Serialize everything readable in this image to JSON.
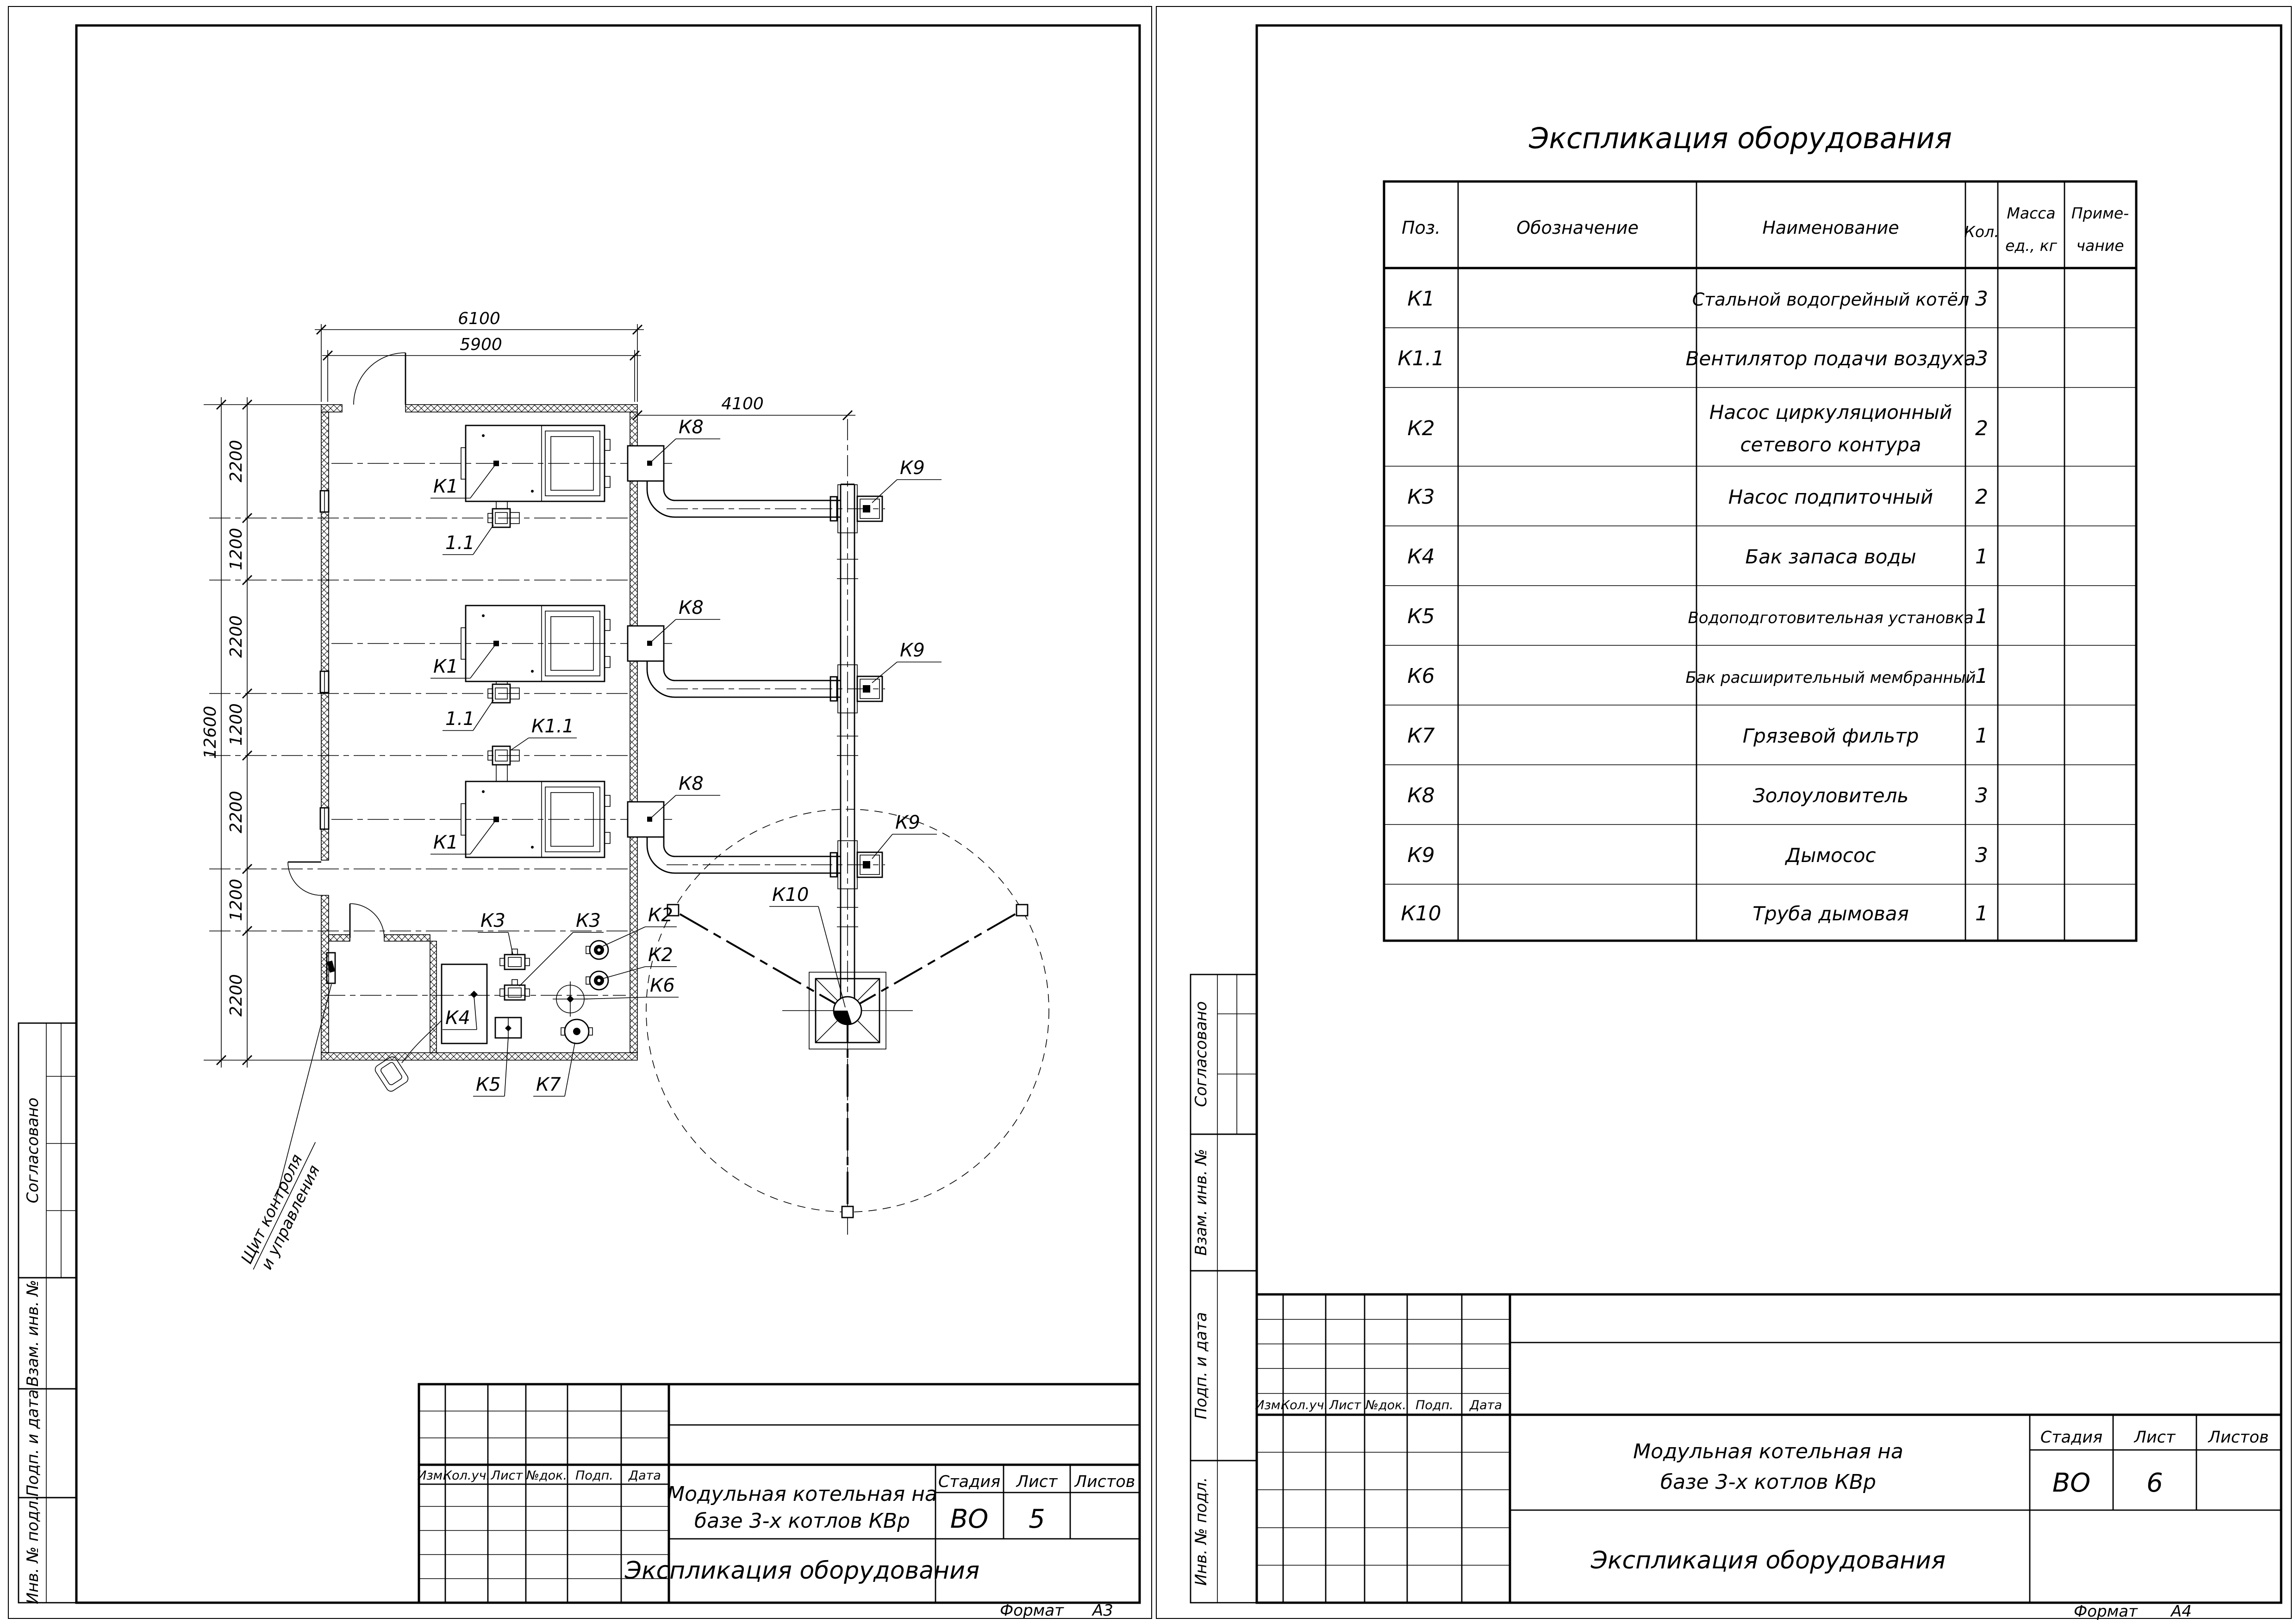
{
  "colors": {
    "paper": "#ffffff",
    "ink": "#000000"
  },
  "plan": {
    "dims": {
      "top_outer": "6100",
      "top_inner": "5900",
      "right": "4100",
      "total": "12600",
      "chain": [
        "2200",
        "1200",
        "2200",
        "1200",
        "2200",
        "1200",
        "2200"
      ]
    },
    "labels": {
      "boiler": "К1",
      "fan_a": "1.1",
      "fan_b": "К1.1",
      "ash": "К8",
      "smoke": "К9",
      "chimney": "К10",
      "pump_feed": "К3",
      "pump_net": "К2",
      "exp_tank": "К6",
      "tank": "К4",
      "wtp": "К5",
      "filter": "К7",
      "panel1": "Щит контроля",
      "panel2": "и управления"
    }
  },
  "equip_table": {
    "title": "Экспликация оборудования",
    "headers": {
      "pos": "Поз.",
      "code": "Обозначение",
      "name": "Наименование",
      "qty": "Кол.",
      "mass1": "Масса",
      "mass2": "ед., кг",
      "note1": "Приме-",
      "note2": "чание"
    },
    "rows": [
      {
        "pos": "К1",
        "name": "Стальной водогрейный котёл",
        "qty": "3"
      },
      {
        "pos": "К1.1",
        "name": "Вентилятор подачи воздуха",
        "qty": "3"
      },
      {
        "pos": "К2",
        "name": "Насос циркуляционный",
        "name2": "сетевого контура",
        "qty": "2"
      },
      {
        "pos": "К3",
        "name": "Насос подпиточный",
        "qty": "2"
      },
      {
        "pos": "К4",
        "name": "Бак запаса воды",
        "qty": "1"
      },
      {
        "pos": "К5",
        "name": "Водоподготовительная установка",
        "qty": "1"
      },
      {
        "pos": "К6",
        "name": "Бак расширительный мембранный",
        "qty": "1"
      },
      {
        "pos": "К7",
        "name": "Грязевой фильтр",
        "qty": "1"
      },
      {
        "pos": "К8",
        "name": "Золоуловитель",
        "qty": "3"
      },
      {
        "pos": "К9",
        "name": "Дымосос",
        "qty": "3"
      },
      {
        "pos": "К10",
        "name": "Труба дымовая",
        "qty": "1"
      }
    ]
  },
  "stamp": {
    "approved": "Согласовано",
    "zam": "Взам. инв. №",
    "podp": "Подп. и дата",
    "inv": "Инв. № подл."
  },
  "title_block": {
    "rev": [
      "Изм.",
      "Кол.уч.",
      "Лист",
      "№док.",
      "Подп.",
      "Дата"
    ],
    "project1": "Модульная котельная на",
    "project2": "базе 3-х котлов КВр",
    "doc": "Экспликация оборудования",
    "stage_h": "Стадия",
    "sheet_h": "Лист",
    "sheets_h": "Листов",
    "stage": "ВО",
    "sheet_left": "5",
    "sheet_right": "6",
    "format_label": "Формат",
    "format_left": "А3",
    "format_right": "А4"
  }
}
